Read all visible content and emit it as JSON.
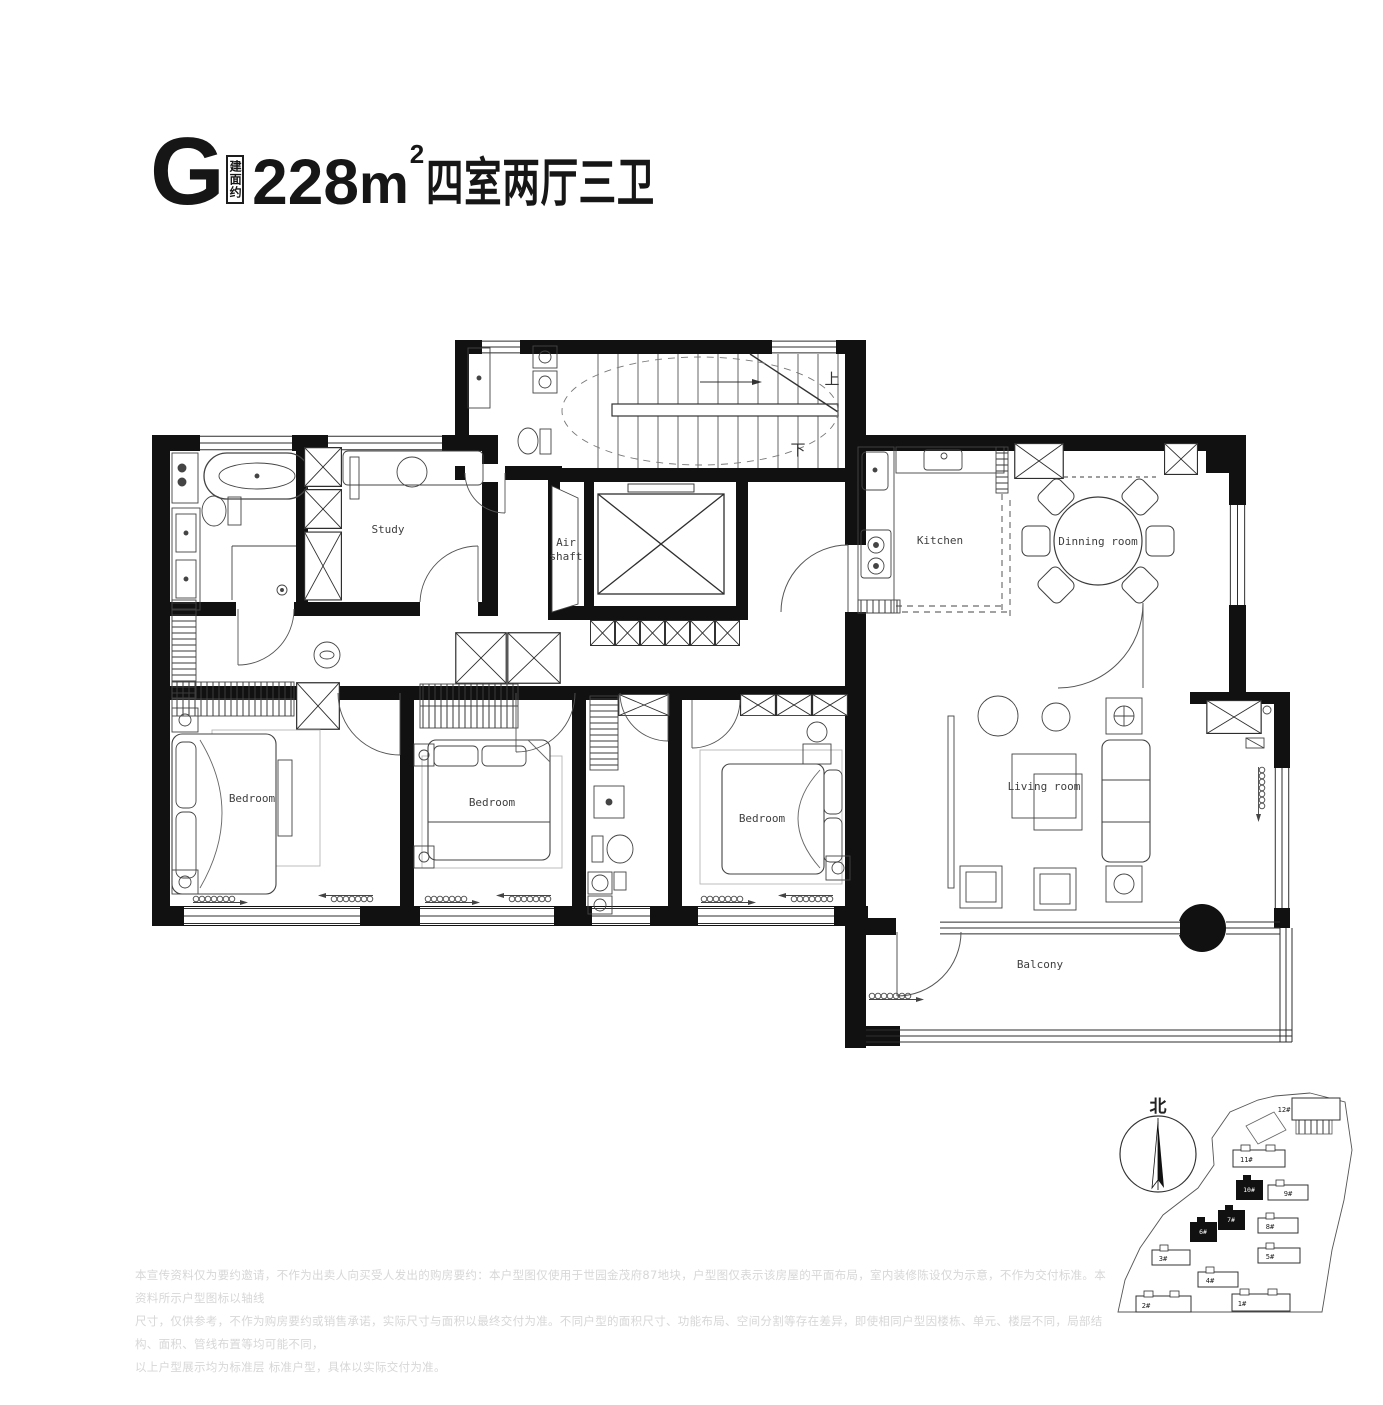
{
  "header": {
    "unit_letter": "G",
    "area_tag": "建面约",
    "area_value": "228",
    "area_unit": "m",
    "area_exponent": "2",
    "rooms_text": "四室两厅三卫"
  },
  "plan": {
    "labels": {
      "study": "Study",
      "air_line1": "Air",
      "air_line2": "shaft",
      "kitchen": "Kitchen",
      "dining": "Dinning room",
      "bedroom_left": "Bedroom",
      "bedroom_middle": "Bedroom",
      "bedroom_right": "Bedroom",
      "living": "Living room",
      "balcony": "Balcony",
      "stair_up": "上",
      "stair_down": "下"
    }
  },
  "compass": {
    "north": "北"
  },
  "siteplan": {
    "buildings": [
      {
        "label": "12#",
        "highlight": false
      },
      {
        "label": "11#",
        "highlight": false
      },
      {
        "label": "10#",
        "highlight": true
      },
      {
        "label": "9#",
        "highlight": false
      },
      {
        "label": "7#",
        "highlight": true
      },
      {
        "label": "8#",
        "highlight": false
      },
      {
        "label": "6#",
        "highlight": true
      },
      {
        "label": "5#",
        "highlight": false
      },
      {
        "label": "3#",
        "highlight": false
      },
      {
        "label": "4#",
        "highlight": false
      },
      {
        "label": "2#",
        "highlight": false
      },
      {
        "label": "1#",
        "highlight": false
      }
    ]
  },
  "disclaimer": {
    "line1": "本宣传资料仅为要约邀请，不作为出卖人向买受人发出的购房要约：本户型图仅使用于世园金茂府87地块，户型图仅表示该房屋的平面布局，室内装修陈设仅为示意，不作为交付标准。本资料所示户型图标以轴线",
    "line2": "尺寸，仅供参考，不作为购房要约或销售承诺，实际尺寸与面积以最终交付为准。不同户型的面积尺寸、功能布局、空间分割等存在差异，即使相同户型因楼栋、单元、楼层不同，局部结构、面积、管线布置等均可能不同，",
    "line3": "以上户型展示均为标准层 标准户型，具体以实际交付为准。"
  },
  "colors": {
    "wall": "#111111",
    "line": "#4a4a4a",
    "label": "#3f3f3f",
    "disclaimer": "#d7d7d7"
  }
}
